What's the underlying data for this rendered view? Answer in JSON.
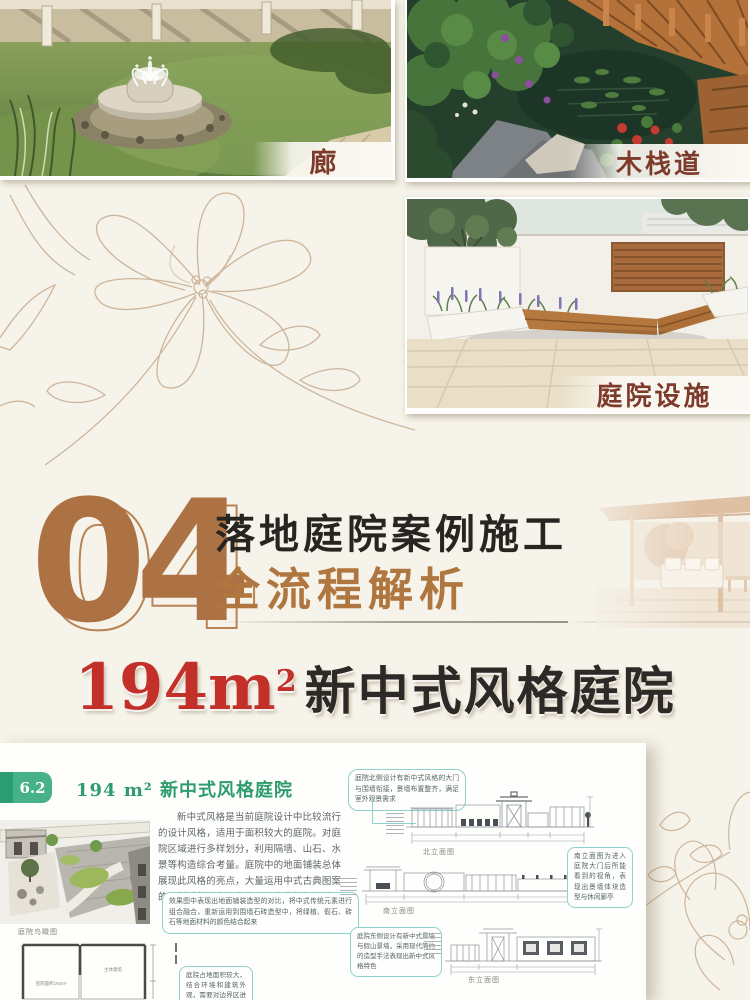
{
  "page": {
    "background": "#f6f3ea",
    "sketch_stroke": "#c6ab8e"
  },
  "gallery": {
    "label_color": "#7e3b2c",
    "photos": [
      {
        "label": "廊",
        "name": "corridor"
      },
      {
        "label": "木栈道",
        "name": "wooden-boardwalk"
      },
      {
        "label": "庭院设施",
        "name": "courtyard-facilities"
      }
    ]
  },
  "section4": {
    "number": "04",
    "number_color": "#ad7243",
    "title_line1": "落地庭院案例施工",
    "title_line2": "全流程解析",
    "title2_color": "#b0763f"
  },
  "headline": {
    "area_value": "194m",
    "area_sup": "2",
    "style_text": "新中式风格庭院",
    "area_color": "#c3302a"
  },
  "book_page": {
    "section_no": "6.2",
    "heading": "194 m² 新中式风格庭院",
    "heading_color": "#2f9c6e",
    "paragraph": "新中式风格是当前庭院设计中比较流行的设计风格，适用于面积较大的庭院。对庭院区域进行多样划分，利用隔墙、山石、水景等构造综合考量。庭院中的地面铺装总体展现此风格的亮点，大量运用中式古典图案的石材铺装，表现出稳重、古典的视觉效果（设计师：常华道）。",
    "callout_pavement": "效果图中表现出地面铺装造型的对比，将中式传统元素进行组合融合，重新运用到围墙石砖造型中，将绿植、假石、砖石等地面材料的颜色结合起来",
    "callout_north": "庭院北侧设计有新中式风格的大门与围墙衔接，景墙布置整齐，满足室外观景需求",
    "callout_south": "南立面图为进入庭院大门后所能看到的视角，表现出景墙体块造型与休闲廊亭",
    "callout_east": "庭院东侧设计有新中式景墙与假山景墙，采用现代简约的造型手法表现出新中式风格特色",
    "callout_plan": "庭院占地面积较大，结合环境和建筑外观，需要对边界区进行划分",
    "aerial_caption": "庭院鸟瞰图",
    "caption_north": "北立面图",
    "caption_south": "南立面图",
    "caption_east": "东立面图",
    "plan_label_left": "后院面积194m²",
    "plan_label_right": "主体建筑"
  }
}
